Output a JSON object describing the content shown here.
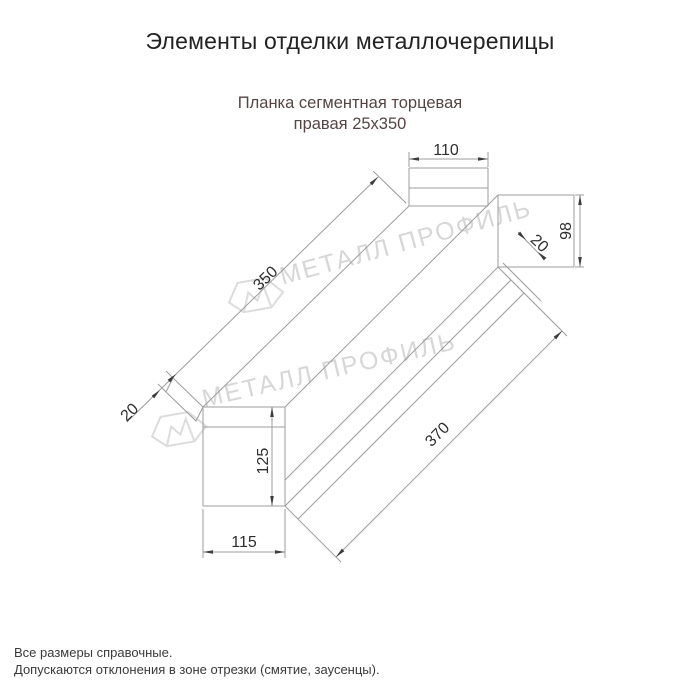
{
  "header": {
    "title": "Элементы отделки металлочерепицы"
  },
  "product": {
    "name_line1": "Планка сегментная торцевая",
    "name_line2": "правая 25х350"
  },
  "watermark": {
    "brand": "МЕТАЛЛ ПРОФИЛЬ"
  },
  "drawing": {
    "dimensions": {
      "top_flange_width": "110",
      "side_height": "98",
      "side_hem": "20",
      "length_top": "350",
      "end_hem": "20",
      "length_bottom": "370",
      "end_view_height": "125",
      "end_view_width": "115"
    }
  },
  "footer": {
    "note_line1": "Все размеры справочные.",
    "note_line2": "Допускаются отклонения в зоне отрезки (смятие, заусенцы)."
  },
  "colors": {
    "subtitle_text": "#554545",
    "drawing_line": "#9c9c9c",
    "dimension_text": "#2e2e2e",
    "watermark": "#d7d7d7"
  }
}
